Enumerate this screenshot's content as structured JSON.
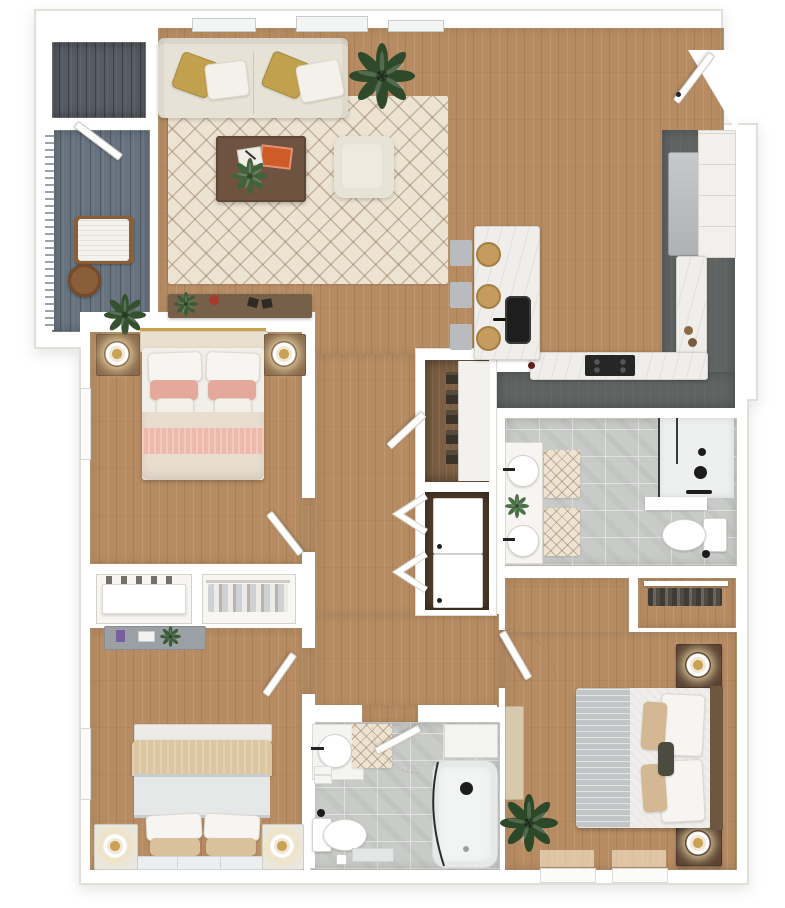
{
  "meta": {
    "title": "3D top-down apartment floor plan render",
    "description": "Photoreal dollhouse-view floor plan: three bedrooms, two bathrooms, open living/kitchen area, balcony, laundry closet",
    "bedrooms": 3,
    "bathrooms": 2
  },
  "colors": {
    "page": "#ffffff",
    "wall": "#ffffff",
    "wall-edge": "#e2dfd9",
    "wood": "#b78c63",
    "deck": "#67737f",
    "slate": "#555c63",
    "kitchen-floor": "#5f6361",
    "tile": "#c9cbc9",
    "marble": "#f0eeea",
    "rug": "#ece3d2",
    "sofa": "#e7e2d6",
    "gold": "#c2a14e",
    "pink": "#e5a99b",
    "pink-stripe": "#edb9ab",
    "cream": "#e8decf",
    "beige": "#dcc6a2",
    "gray-throw": "#c3c6c6",
    "walnut": "#6e5440",
    "steel": "#b9bcbe",
    "plant": "#2f4c2c",
    "black-fixture": "#222222"
  },
  "rooms": {
    "balcony": {
      "label": "Balcony",
      "items": [
        "storage closet",
        "railing",
        "lounge chair",
        "round side table",
        "potted plant"
      ]
    },
    "living_room": {
      "label": "Living room",
      "items": [
        "sofa",
        "gold pillows",
        "white pillows",
        "trellis rug",
        "coffee table",
        "orange book",
        "notebook",
        "small plant",
        "accent chair",
        "floor plant",
        "console table",
        "windows"
      ]
    },
    "kitchen": {
      "label": "Kitchen",
      "items": [
        "island with sink and faucet",
        "three counter stools",
        "cooktop",
        "L-shaped marble counter",
        "refrigerator",
        "cabinets",
        "entry door"
      ]
    },
    "bedroom_1": {
      "label": "Bedroom 1",
      "items": [
        "bed with blush bedding",
        "two nightstands",
        "two lamps",
        "window",
        "door"
      ]
    },
    "bedroom_2": {
      "label": "Bedroom 2",
      "items": [
        "bed with beige bedding",
        "two nightstands",
        "two lamps",
        "dresser",
        "window",
        "door"
      ]
    },
    "master_bedroom": {
      "label": "Master bedroom",
      "items": [
        "bed with gray throw",
        "two nightstands",
        "two lamps",
        "bench",
        "floor plant",
        "closet",
        "door",
        "windows"
      ]
    },
    "bathroom_1": {
      "label": "Bathroom 1",
      "items": [
        "double vanity",
        "two sinks",
        "plant",
        "two bath mats",
        "walk-in shower",
        "toilet"
      ]
    },
    "bathroom_2": {
      "label": "Bathroom 2",
      "items": [
        "vanity sink",
        "towels",
        "bath mat",
        "toilet",
        "tub shower with glass door",
        "door"
      ]
    },
    "hallway": {
      "label": "Hallway",
      "items": []
    },
    "pantry_closet": {
      "label": "Pantry closet",
      "items": [
        "shelving",
        "door"
      ]
    },
    "laundry_closet": {
      "label": "Laundry closet",
      "items": [
        "stacked washer and dryer",
        "bifold doors"
      ]
    },
    "closet_1": {
      "label": "Closet 1",
      "items": [
        "shelf with shoes"
      ]
    },
    "closet_2": {
      "label": "Closet 2",
      "items": [
        "hanging clothes"
      ]
    }
  }
}
